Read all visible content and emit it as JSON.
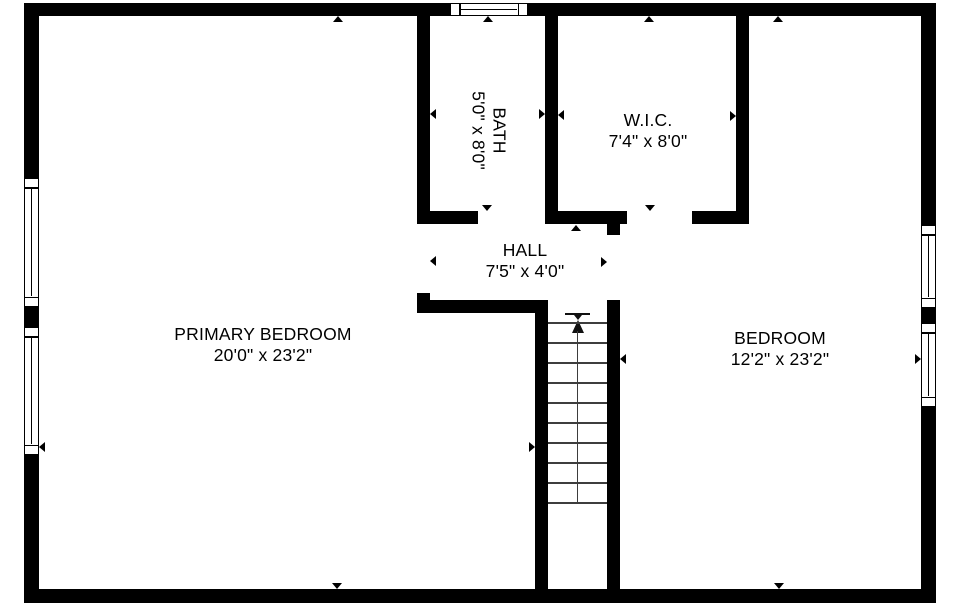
{
  "colors": {
    "wall": "#000000",
    "background": "#ffffff",
    "stair_line": "#3d3d3d"
  },
  "rooms": {
    "primary_bedroom": {
      "name": "PRIMARY BEDROOM",
      "dimensions": "20'0\" x 23'2\""
    },
    "bedroom": {
      "name": "BEDROOM",
      "dimensions": "12'2\" x 23'2\""
    },
    "bath": {
      "name": "BATH",
      "dimensions": "5'0\" x 8'0\""
    },
    "wic": {
      "name": "W.I.C.",
      "dimensions": "7'4\" x 8'0\""
    },
    "hall": {
      "name": "HALL",
      "dimensions": "7'5\" x 4'0\""
    }
  },
  "stairs": {
    "direction": "up",
    "tread_count": 10
  },
  "icons": {
    "wall_marker": "small triangle pointing at wall midpoint",
    "door_marker": "small triangle in door opening",
    "stair_arrow": "arrow-up",
    "window": "double-line window symbol"
  },
  "window_count": 5
}
